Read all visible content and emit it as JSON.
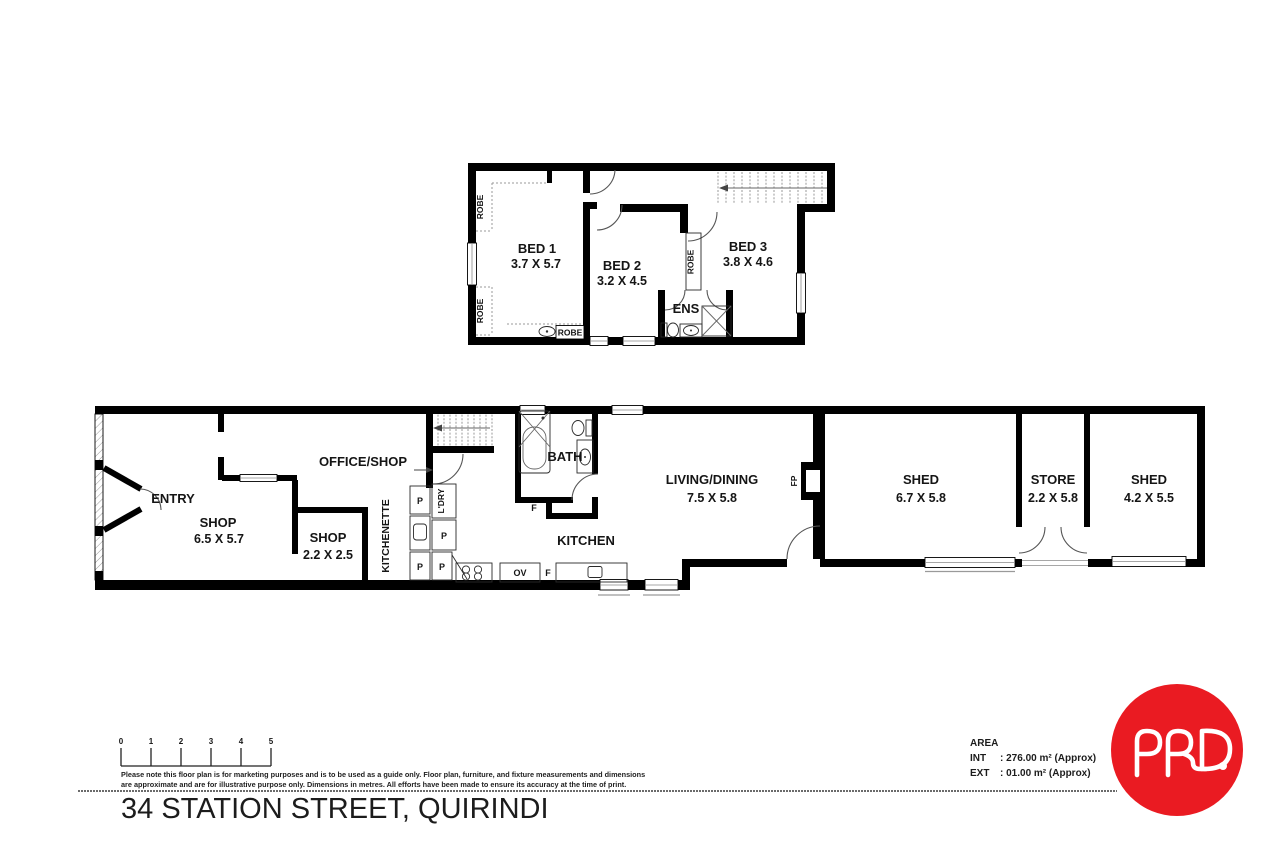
{
  "upper_floor": {
    "rooms": [
      {
        "name": "BED 1",
        "dims": "3.7 X 5.7"
      },
      {
        "name": "BED 2",
        "dims": "3.2 X 4.5"
      },
      {
        "name": "BED 3",
        "dims": "3.8 X 4.6"
      },
      {
        "name": "ENS",
        "dims": ""
      }
    ],
    "labels": {
      "robe": "ROBE"
    }
  },
  "ground_floor": {
    "rooms": [
      {
        "name": "ENTRY",
        "dims": ""
      },
      {
        "name": "SHOP",
        "dims": "6.5 X 5.7"
      },
      {
        "name": "SHOP",
        "dims": "2.2 X 2.5"
      },
      {
        "name": "OFFICE/SHOP",
        "dims": ""
      },
      {
        "name": "BATH",
        "dims": ""
      },
      {
        "name": "KITCHEN",
        "dims": ""
      },
      {
        "name": "LIVING/DINING",
        "dims": "7.5 X 5.8"
      },
      {
        "name": "SHED",
        "dims": "6.7 X 5.8"
      },
      {
        "name": "STORE",
        "dims": "2.2 X 5.8"
      },
      {
        "name": "SHED",
        "dims": "4.2 X 5.5"
      }
    ],
    "labels": {
      "kitchenette": "KITCHENETTE",
      "ldry": "L'DRY",
      "fp": "FP",
      "p": "P",
      "f": "F",
      "ov": "OV"
    }
  },
  "footer": {
    "scale_bar": {
      "ticks": [
        "0",
        "1",
        "2",
        "3",
        "4",
        "5"
      ]
    },
    "disclaimer": {
      "line1": "Please note this floor plan is for marketing purposes and is to be used as a guide only. Floor plan, furniture, and fixture measurements and dimensions",
      "line2": "are approximate and are for illustrative purpose only. Dimensions in metres. All efforts have been made to ensure its accuracy at the time of print."
    },
    "address": "34 STATION STREET, QUIRINDI",
    "area": {
      "heading": "AREA",
      "rows": [
        {
          "label": "INT",
          "value": ": 276.00 m² (Approx)"
        },
        {
          "label": "EXT",
          "value": ": 01.00 m² (Approx)"
        }
      ]
    },
    "logo": {
      "name": "PRD.",
      "background": "#ea1b22"
    }
  }
}
